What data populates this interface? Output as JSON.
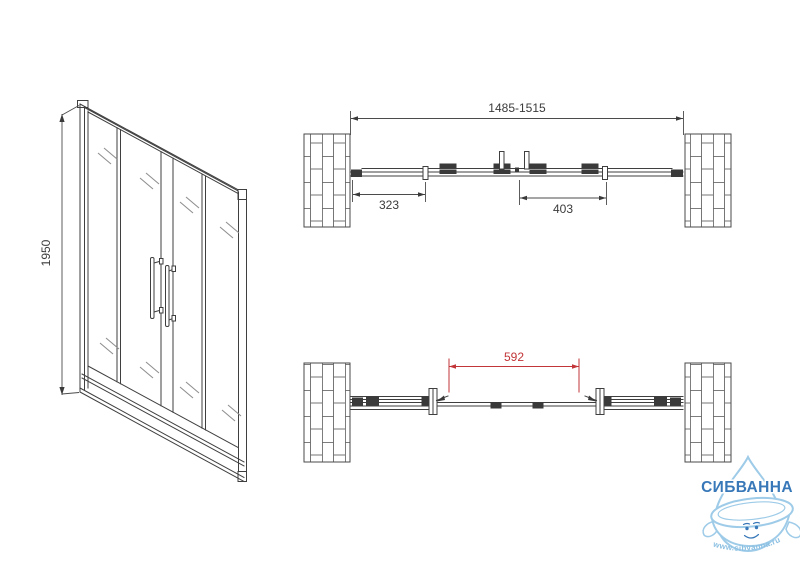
{
  "front_view": {
    "height_label": "1950"
  },
  "plan_view_closed": {
    "overall_width_label": "1485-1515",
    "left_panel_label": "323",
    "door_panel_label": "403"
  },
  "plan_view_open": {
    "opening_label": "592"
  },
  "logo": {
    "brand": "СИБВАННА",
    "website": "www.sibvanna.ru"
  },
  "colors": {
    "line": "#3f3f3f",
    "dimension_red": "#c23538",
    "logo_blue": "#3878b8",
    "logo_light_blue": "#9ecbe8",
    "background": "#ffffff"
  }
}
